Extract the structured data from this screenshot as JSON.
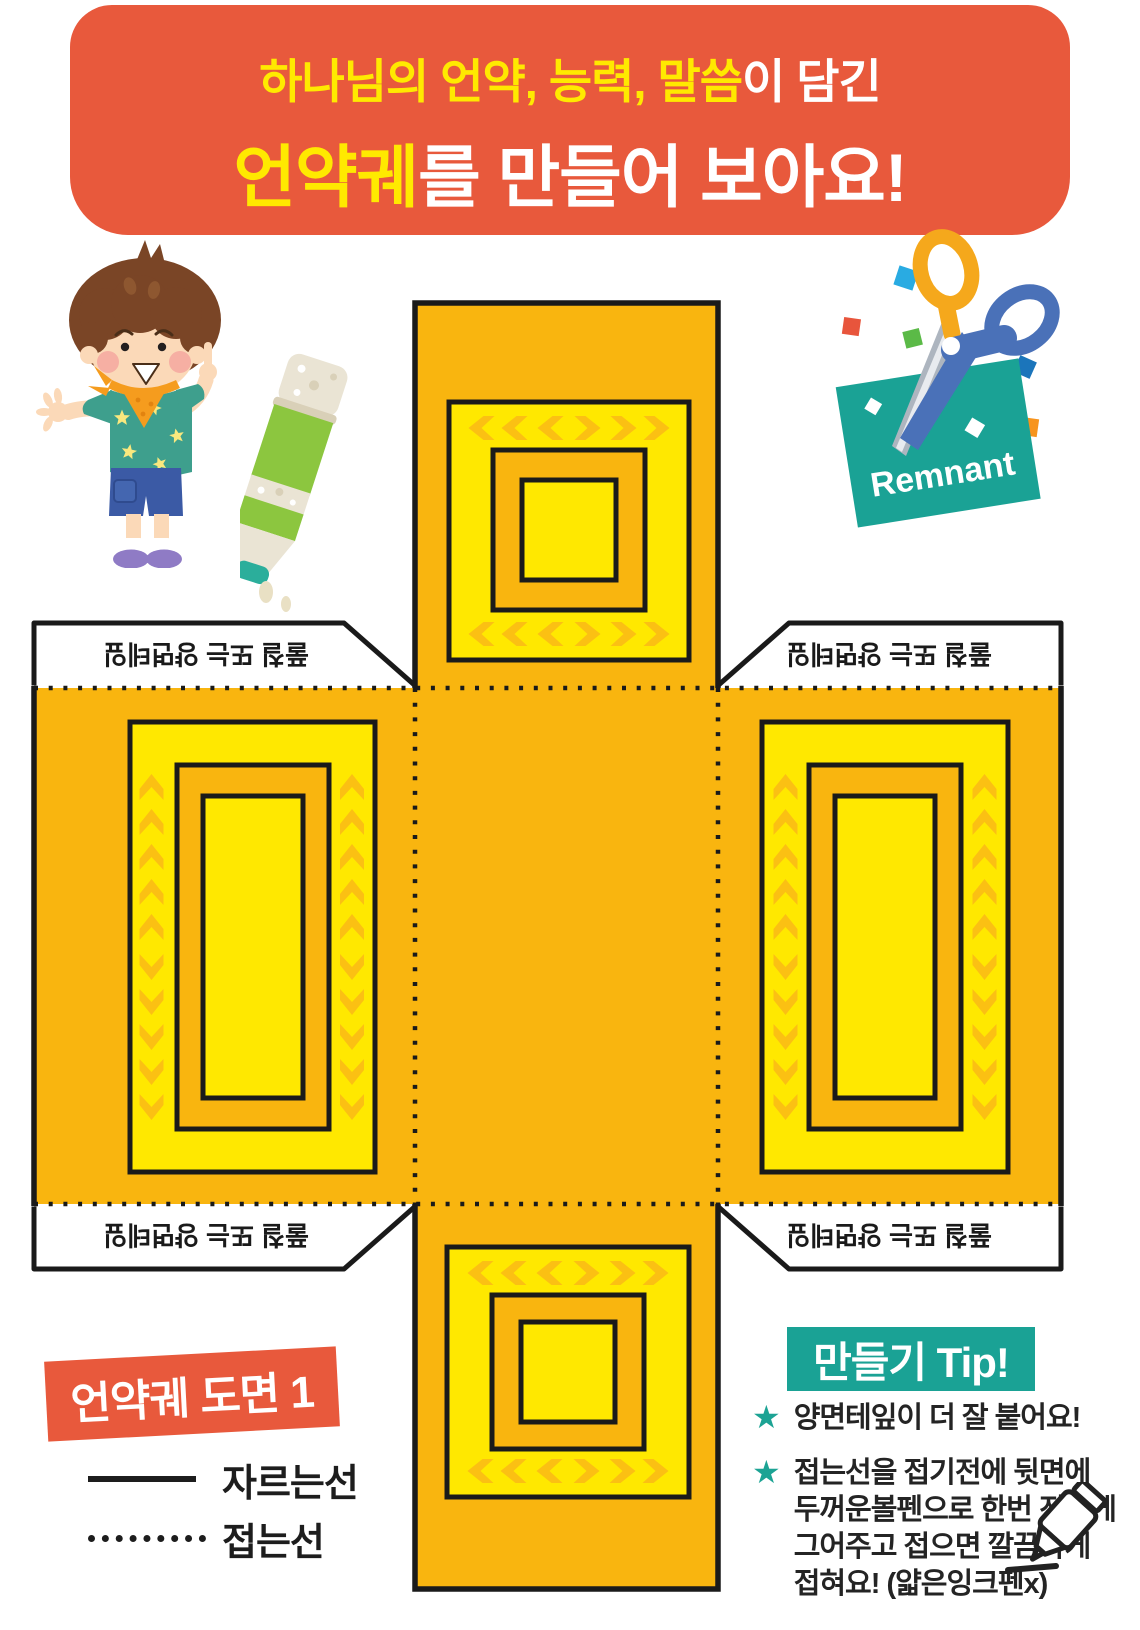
{
  "banner": {
    "line1_highlight": "하나님의 언약, 능력, 말씀",
    "line1_rest": "이 담긴",
    "line2_highlight": "언약궤",
    "line2_rest": "를 만들어 보아요!",
    "bg_color": "#E8593C",
    "highlight_color": "#FFE900"
  },
  "illustrations": {
    "remnant_label": "Remnant"
  },
  "template": {
    "glue_tab_text": "풀칠 또는 양면테잎",
    "colors": {
      "orange": "#F9B50F",
      "yellow": "#FFE800",
      "chevron": "#FBC013",
      "outline": "#1A1A1A",
      "tab_bg": "#FFFFFF"
    }
  },
  "footer": {
    "diagram_label": "언약궤 도면 1",
    "legend_cut": "자르는선",
    "legend_fold": "접는선"
  },
  "tips": {
    "heading": "만들기 Tip!",
    "star_bullet": "★",
    "tip1": "양면테잎이 더 잘 붙어요!",
    "tip2_lines": [
      "접는선을 접기전에 뒷면에",
      "두꺼운볼펜으로 한번 진하게",
      "그어주고 접으면 깔끔하게",
      "접혀요! (얇은잉크펜x)"
    ]
  }
}
